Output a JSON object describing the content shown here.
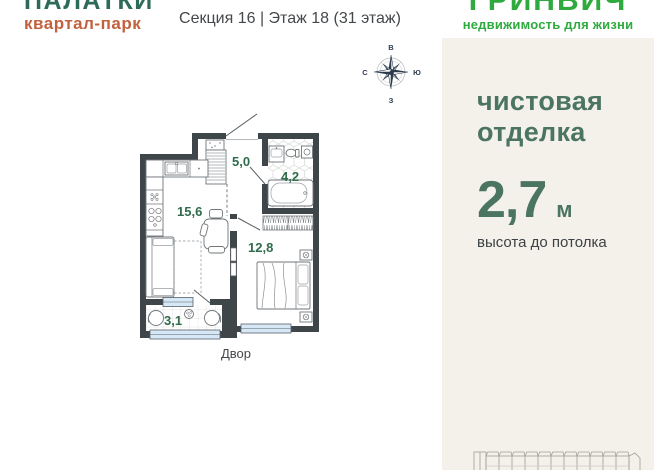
{
  "brand": {
    "name": "ПАЛАТКИ",
    "subtitle": "квартал-парк"
  },
  "header": {
    "section_info": "Секция 16 | Этаж 18 (31 этаж)"
  },
  "developer": {
    "name": "ГРИНВИЧ",
    "tagline": "недвижимость для жизни"
  },
  "compass": {
    "top": "В",
    "left": "С",
    "right": "Ю",
    "bottom": "З"
  },
  "floorplan": {
    "yard_label": "Двор",
    "rooms": [
      {
        "name": "hallway",
        "area": "5,0"
      },
      {
        "name": "bathroom",
        "area": "4,2"
      },
      {
        "name": "kitchen-living",
        "area": "15,6"
      },
      {
        "name": "bedroom",
        "area": "12,8"
      },
      {
        "name": "balcony",
        "area": "3,1"
      }
    ]
  },
  "panel": {
    "finish_line1": "чистовая",
    "finish_line2": "отделка",
    "ceiling_value": "2,7",
    "ceiling_unit": "м",
    "ceiling_caption": "высота до потолка"
  },
  "colors": {
    "brand_green": "#2d6a5a",
    "brand_orange": "#c2613d",
    "developer_green": "#2faa3f",
    "panel_background": "#f4f0ea",
    "accent_green": "#4b7560",
    "room_label_green": "#2f6b4c",
    "wall_dark": "#3f464a",
    "window_blue": "#d6e8f5",
    "compass_navy": "#2c3b4e",
    "text_dark": "#45484b"
  }
}
